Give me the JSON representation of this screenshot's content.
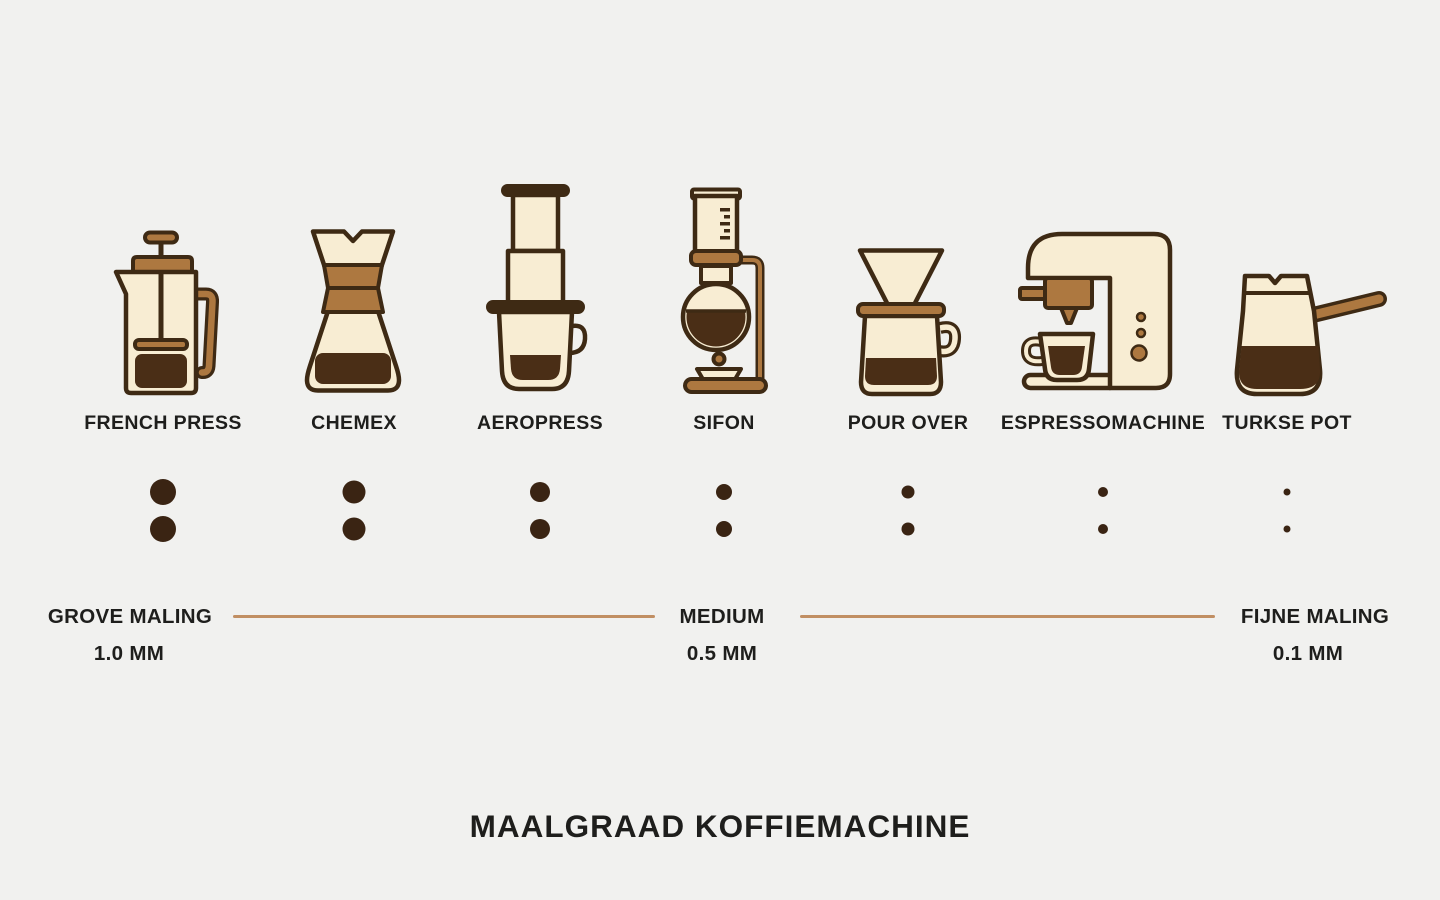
{
  "title": "MAALGRAAD KOFFIEMACHINE",
  "methods": [
    {
      "name": "FRENCH PRESS",
      "icon": "french-press",
      "grind_dot_px": 26
    },
    {
      "name": "CHEMEX",
      "icon": "chemex",
      "grind_dot_px": 23
    },
    {
      "name": "AEROPRESS",
      "icon": "aeropress",
      "grind_dot_px": 20
    },
    {
      "name": "SIFON",
      "icon": "sifon",
      "grind_dot_px": 16
    },
    {
      "name": "POUR OVER",
      "icon": "pour-over",
      "grind_dot_px": 13
    },
    {
      "name": "ESPRESSOMACHINE",
      "icon": "espressomachine",
      "grind_dot_px": 10
    },
    {
      "name": "TURKSE POT",
      "icon": "turkse-pot",
      "grind_dot_px": 7
    }
  ],
  "scale": {
    "levels": [
      {
        "label": "GROVE MALING",
        "value": "1.0 MM"
      },
      {
        "label": "MEDIUM",
        "value": "0.5 MM"
      },
      {
        "label": "FIJNE MALING",
        "value": "0.1 MM"
      }
    ]
  },
  "colors": {
    "background": "#F1F1EF",
    "outline": "#3E2A14",
    "cream": "#F8EDD3",
    "brown": "#AD7840",
    "coffee": "#4A2E16",
    "dot": "#3A2413",
    "scale_line": "#C18F63",
    "text": "#1E1E1C"
  }
}
